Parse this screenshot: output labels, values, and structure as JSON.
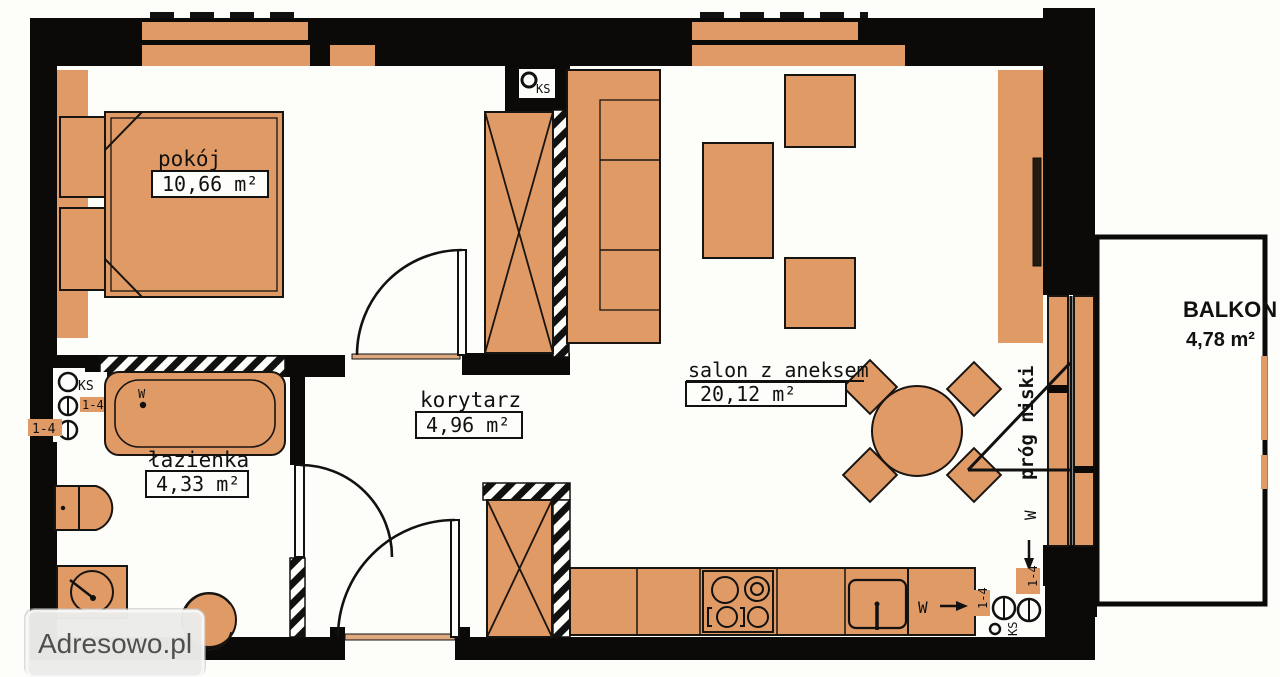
{
  "watermark": {
    "text": "Adresowo.pl"
  },
  "rooms": {
    "pokoj": {
      "name": "pokój",
      "area": "10,66 m²"
    },
    "lazienka": {
      "name": "łazienka",
      "area": "4,33 m²"
    },
    "korytarz": {
      "name": "korytarz",
      "area": "4,96 m²"
    },
    "salon": {
      "name": "salon z aneksem",
      "area": "20,12 m²"
    },
    "balkon": {
      "name": "BALKON",
      "area": "4,78 m²"
    }
  },
  "annotations": {
    "prog_niski": "próg niski",
    "w_label": "W",
    "ks_label": "KS",
    "meter_range": "1-4"
  },
  "colors": {
    "furniture": "#e09a66",
    "wall": "#0b0a08",
    "paper": "#fdfdf9",
    "watermark_text": "#4f4f4f"
  }
}
